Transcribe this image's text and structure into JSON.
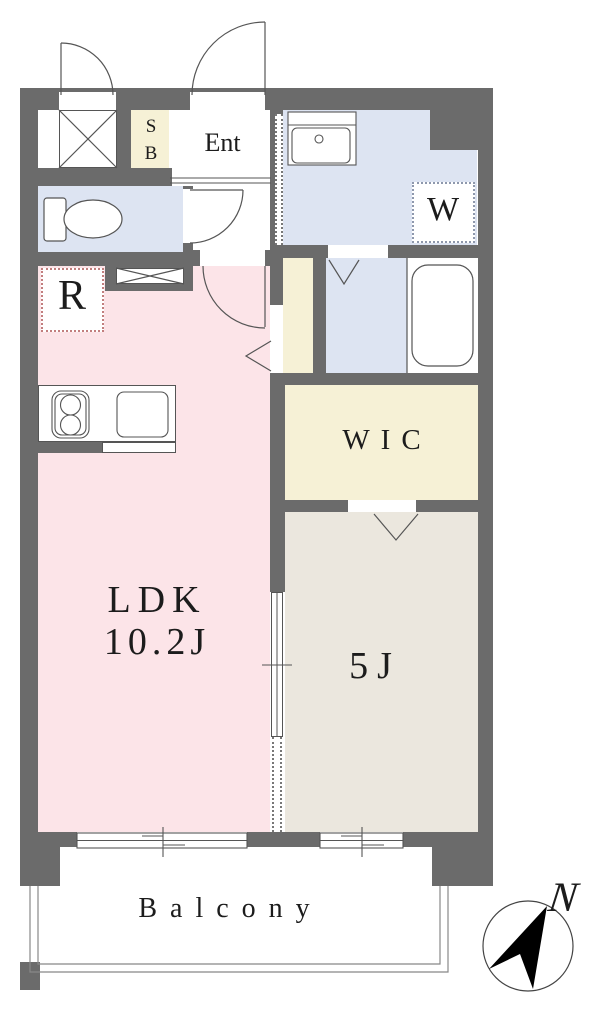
{
  "rooms": {
    "ent": "Ent",
    "sb": "SB",
    "washer": "W",
    "refrigerator": "R",
    "wic": "WIC",
    "ldk": "LDK",
    "ldk_size": "10.2J",
    "bedroom_size": "5J",
    "balcony": "Balcony"
  },
  "compass": {
    "north": "N"
  },
  "colors": {
    "wall": "#6b6b6b",
    "floor_pink": "#fce4e8",
    "floor_blue": "#dde4f2",
    "floor_cream": "#f6f1d6",
    "floor_greige": "#ebe7de",
    "dot_red": "#c27e7e",
    "dot_blue": "#8e98ad"
  }
}
